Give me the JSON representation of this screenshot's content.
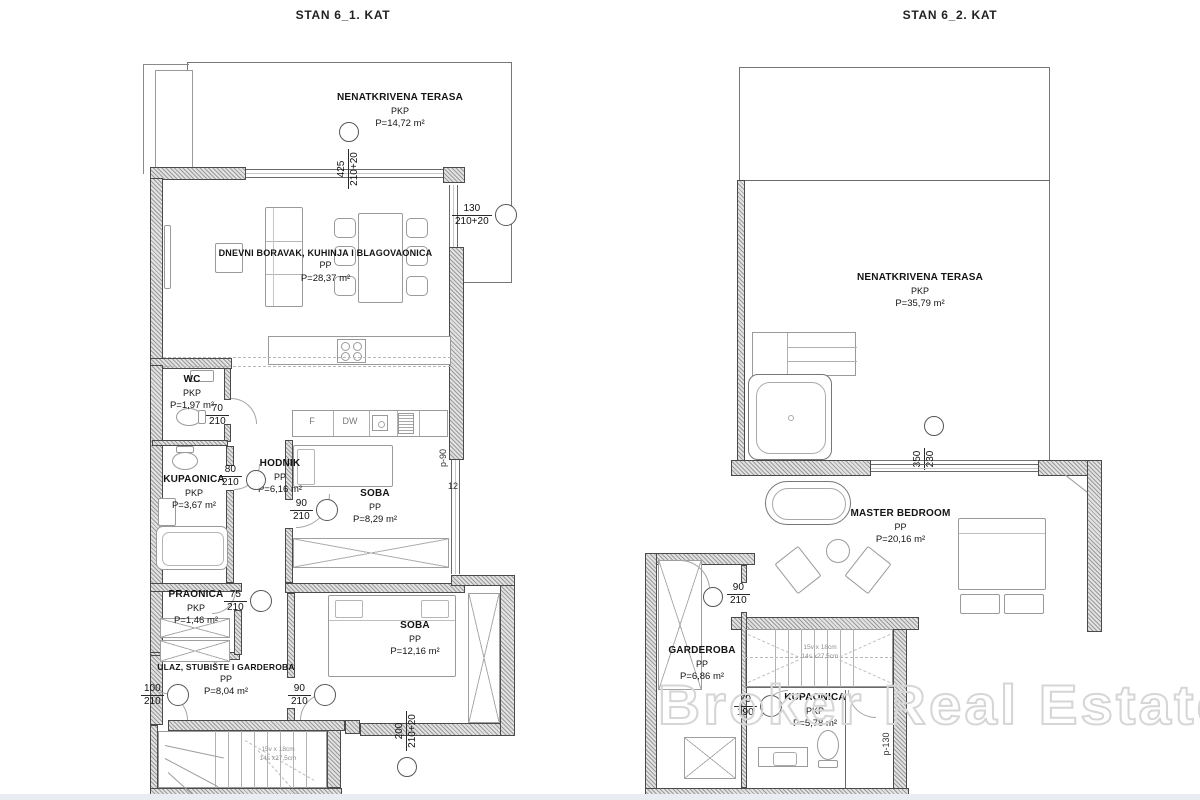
{
  "watermark": "Broker Real Estate",
  "colors": {
    "wall_line": "#4a4a4a",
    "hatch": "#9b9b9b",
    "text": "#141414",
    "watermark": "#d6d6d6"
  },
  "plans": [
    {
      "title": "STAN 6_1. KAT",
      "rooms": {
        "terasa": {
          "name": "NENATKRIVENA TERASA",
          "type": "PKP",
          "area": "P=14,72 m²"
        },
        "dnevni": {
          "name": "DNEVNI BORAVAK, KUHINJA I BLAGOVAONICA",
          "type": "PP",
          "area": "P=28,37 m²"
        },
        "wc": {
          "name": "WC",
          "type": "PKP",
          "area": "P=1,97 m²"
        },
        "kupaonica": {
          "name": "KUPAONICA",
          "type": "PKP",
          "area": "P=3,67 m²"
        },
        "hodnik": {
          "name": "HODNIK",
          "type": "PP",
          "area": "P=6,16 m²"
        },
        "soba1": {
          "name": "SOBA",
          "type": "PP",
          "area": "P=8,29 m²"
        },
        "praonica": {
          "name": "PRAONICA",
          "type": "PKP",
          "area": "P=1,46 m²"
        },
        "ulaz": {
          "name": "ULAZ, STUBIŠTE I GARDEROBA",
          "type": "PP",
          "area": "P=8,04 m²"
        },
        "soba2": {
          "name": "SOBA",
          "type": "PP",
          "area": "P=12,16 m²"
        }
      },
      "dims": {
        "terrace_v": {
          "a": "425",
          "b": "210+20"
        },
        "win_right": {
          "a": "130",
          "b": "210+20"
        },
        "wc_door": {
          "a": "70",
          "b": "210"
        },
        "kup_door": {
          "a": "80",
          "b": "210"
        },
        "soba1_door": {
          "a": "90",
          "b": "210"
        },
        "praonica_door": {
          "a": "75",
          "b": "210"
        },
        "entry_door": {
          "a": "100",
          "b": "210"
        },
        "ulaz_door": {
          "a": "90",
          "b": "210"
        },
        "soba2_v": {
          "a": "200",
          "b": "210+20"
        },
        "parapet": "p-90",
        "twelve": "12"
      },
      "kitchen": {
        "fridge": "F",
        "dishwasher": "DW"
      },
      "stairs_note": {
        "line1": "15v x 18cm",
        "line2": "14s x27,5cm"
      }
    },
    {
      "title": "STAN 6_2. KAT",
      "rooms": {
        "terasa": {
          "name": "NENATKRIVENA TERASA",
          "type": "PKP",
          "area": "P=35,79 m²"
        },
        "master": {
          "name": "MASTER BEDROOM",
          "type": "PP",
          "area": "P=20,16 m²"
        },
        "garderoba": {
          "name": "GARDEROBA",
          "type": "PP",
          "area": "P=6,86 m²"
        },
        "kupaonica": {
          "name": "KUPAONICA",
          "type": "PKP",
          "area": "P=5,78 m²"
        }
      },
      "dims": {
        "terrace_v": {
          "a": "350",
          "b": "230"
        },
        "gard_door": {
          "a": "90",
          "b": "210"
        },
        "kup_door": {
          "a": "70",
          "b": "190"
        },
        "parapet": "p-130"
      },
      "stairs_note": {
        "line1": "15v x 18cm",
        "line2": "14s x27,5cm"
      }
    }
  ]
}
